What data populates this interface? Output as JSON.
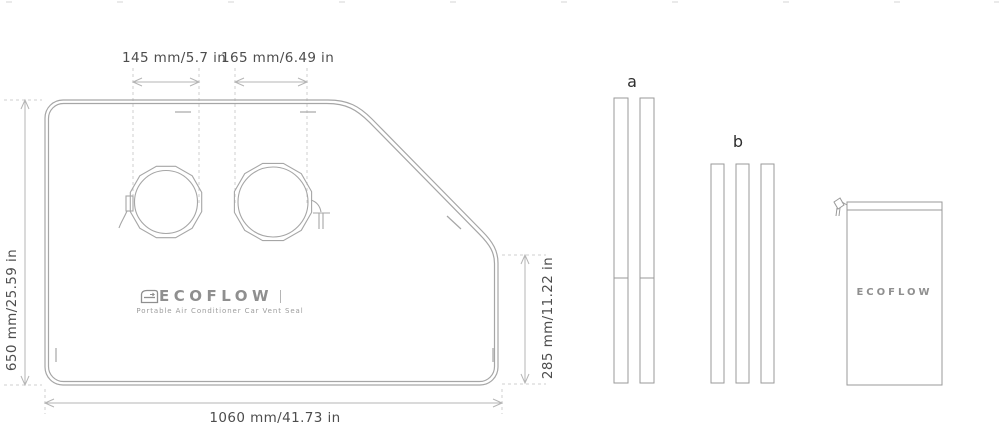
{
  "artwork": {
    "brand": "ECOFLOW",
    "product_subtitle": "Portable Air Conditioner Car Vent Seal"
  },
  "dimensions": {
    "vent_hole_left": "145 mm/5.7 in",
    "vent_hole_right": "165 mm/6.49 in",
    "height": "650 mm/25.59 in",
    "right_edge": "285 mm/11.22 in",
    "width": "1060 mm/41.73 in"
  },
  "parts": {
    "bars_group_a_label": "a",
    "bars_group_b_label": "b",
    "bag_brand": "ECOFLOW"
  },
  "colors": {
    "outline": "#a6a6a6",
    "dimension_line": "#b5b5b5",
    "dashed_line": "#cfcfcf",
    "dimension_text": "#4d4d4d",
    "label_text": "#2e2e2e",
    "logo_gray": "#8f8f8f"
  }
}
